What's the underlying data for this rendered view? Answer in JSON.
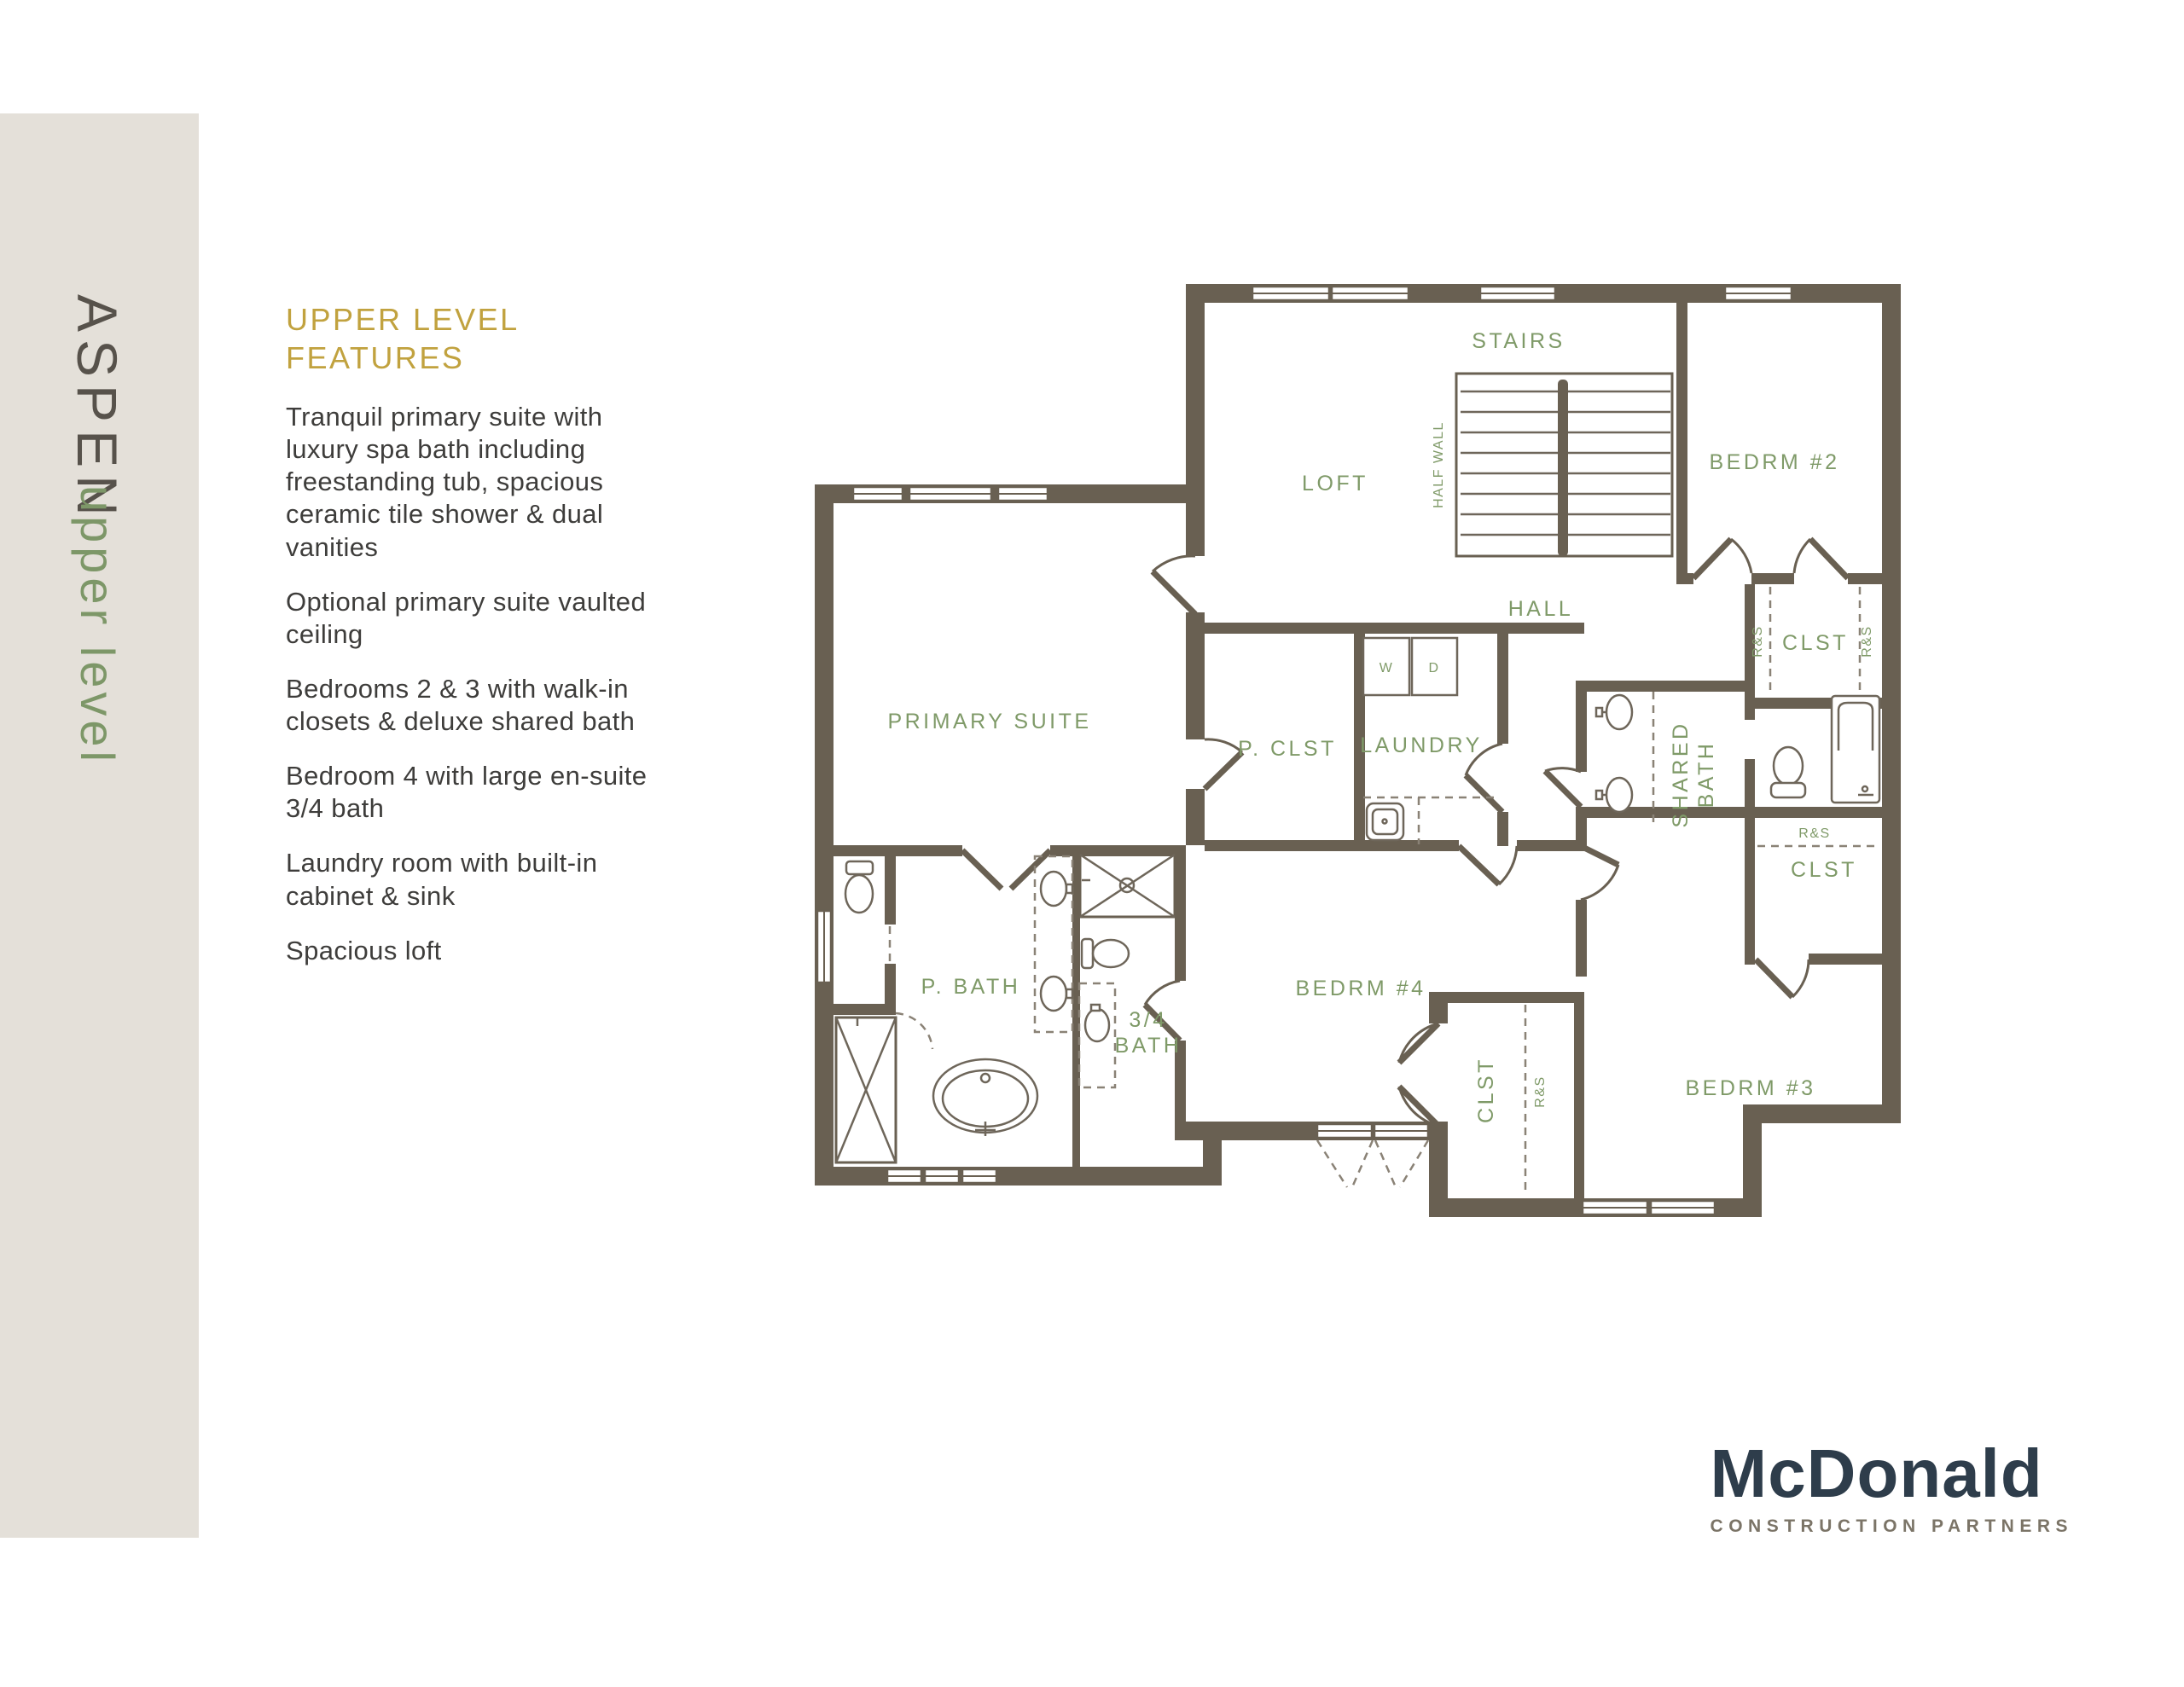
{
  "sidebar": {
    "title": "ASPEN",
    "subtitle": "upper level",
    "bg_color": "#e4e0d9",
    "title_color": "#57524b",
    "subtitle_color": "#7d9768"
  },
  "features": {
    "heading": "UPPER LEVEL FEATURES",
    "heading_color": "#c1a23f",
    "items": [
      "Tranquil primary suite with luxury spa bath including freestanding tub, spacious ceramic tile shower & dual vanities",
      "Optional primary suite vaulted ceiling",
      "Bedrooms 2 & 3 with walk-in closets & deluxe shared bath",
      "Bedroom 4 with large en-suite 3/4 bath",
      "Laundry room with built-in cabinet & sink",
      "Spacious loft"
    ]
  },
  "floorplan": {
    "wall_color": "#696052",
    "label_color": "#7f9a68",
    "labels": {
      "loft": "LOFT",
      "stairs": "STAIRS",
      "half_wall": "HALF WALL",
      "hall": "HALL",
      "bedrm2": "BEDRM #2",
      "bedrm3": "BEDRM #3",
      "bedrm4": "BEDRM #4",
      "primary_suite": "PRIMARY SUITE",
      "p_clst": "P. CLST",
      "laundry": "LAUNDRY",
      "washer": "W",
      "dryer": "D",
      "shared_bath_line1": "SHARED",
      "shared_bath_line2": "BATH",
      "p_bath": "P. BATH",
      "bath34_line1": "3/4",
      "bath34_line2": "BATH",
      "clst": "CLST",
      "rs": "R&S"
    }
  },
  "logo": {
    "name": "McDonald",
    "tagline": "CONSTRUCTION PARTNERS",
    "name_color": "#2e3d4b",
    "tagline_color": "#7b7467"
  }
}
